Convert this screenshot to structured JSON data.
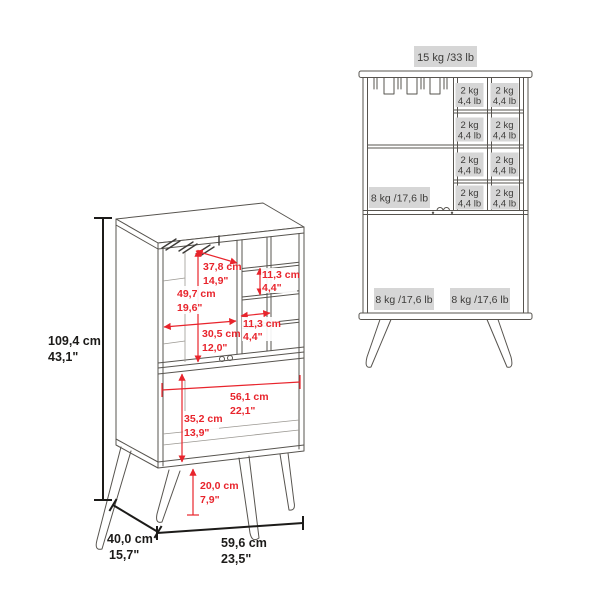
{
  "left_diagram": {
    "description": "perspective view with dimensions",
    "dims": {
      "total_height_cm": "109,4 cm",
      "total_height_in": "43,1\"",
      "interior_depth_cm": "37,8 cm",
      "interior_depth_in": "14,9\"",
      "upper_section_height_cm": "49,7 cm",
      "upper_section_height_in": "19,6\"",
      "cubby_height_cm": "11,3 cm",
      "cubby_height_in": "4,4\"",
      "cubby_width_cm": "11,3 cm",
      "cubby_width_in": "4,4\"",
      "upper_section_width_cm": "30,5 cm",
      "upper_section_width_in": "12,0\"",
      "lower_section_width_cm": "56,1 cm",
      "lower_section_width_in": "22,1\"",
      "lower_section_height_cm": "35,2 cm",
      "lower_section_height_in": "13,9\"",
      "leg_height_cm": "20,0 cm",
      "leg_height_in": "7,9\"",
      "total_depth_cm": "40,0 cm",
      "total_depth_in": "15,7\"",
      "total_width_cm": "59,6 cm",
      "total_width_in": "23,5\""
    }
  },
  "right_diagram": {
    "description": "front view with weight capacities",
    "capacities": {
      "top_surface": "15 kg /33 lb",
      "cubby_kg": "2 kg",
      "cubby_lb": "4,4 lb",
      "middle_shelf": "8 kg /17,6 lb",
      "bottom_left": "8 kg /17,6 lb",
      "bottom_right": "8 kg /17,6 lb"
    }
  },
  "colors": {
    "dimension_red": "#e8242c",
    "dimension_black": "#1c1b19",
    "furniture_line": "#57544f",
    "label_background": "#d6d6d6",
    "label_text": "#3d3c3a"
  }
}
